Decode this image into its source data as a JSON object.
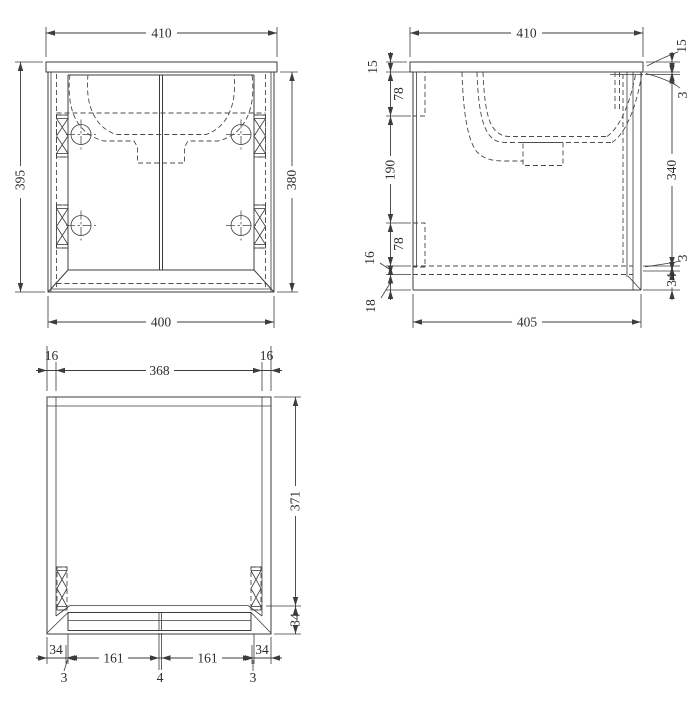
{
  "title": "vanity unit technical drawing",
  "colors": {
    "line": "#3c3c3c",
    "background": "#ffffff",
    "text": "#2e2e2e"
  },
  "views": {
    "front": {
      "label": "front view",
      "dim_top": "410",
      "dim_left": "395",
      "dim_right": "380",
      "dim_bottom": "400"
    },
    "side": {
      "label": "side section view",
      "dim_top": "410",
      "dim_bottom": "405",
      "left_chain": [
        "15",
        "78",
        "190",
        "78",
        "16",
        "18"
      ],
      "right_chain": [
        "15",
        "3",
        "340",
        "3",
        "34"
      ]
    },
    "bottom": {
      "label": "bottom view",
      "top_chain": [
        "16",
        "368",
        "16"
      ],
      "right_chain": [
        "371",
        "34"
      ],
      "bottom_chain": [
        "34",
        "161",
        "161",
        "34"
      ],
      "leaders": [
        "3",
        "4",
        "3"
      ]
    }
  }
}
